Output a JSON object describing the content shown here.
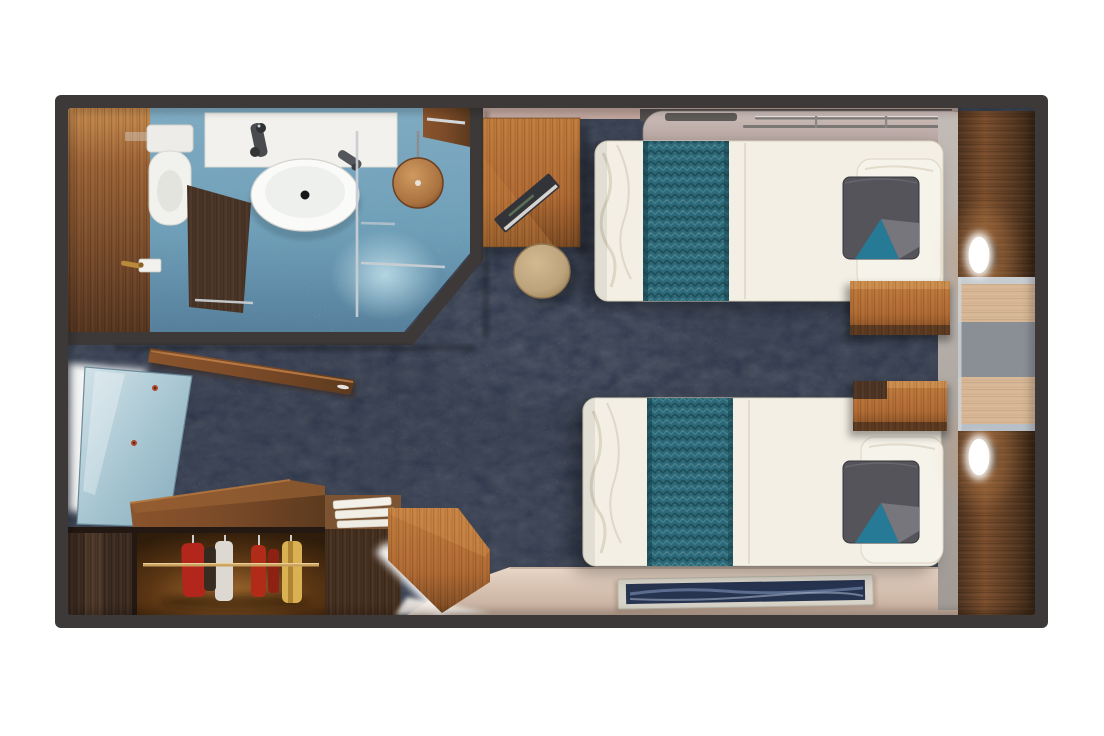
{
  "page": {
    "background_color": "#ffffff"
  },
  "floorplan": {
    "title": "Cruise stateroom floor plan — top-down 3D render",
    "rooms": {
      "bathroom": {
        "items": [
          "wood entry floor",
          "toilet",
          "vanity counter with oval washbasin",
          "chrome faucets",
          "glass shower partition",
          "bronze rain shower head",
          "towel rail",
          "blue tile floor",
          "angled corner wall"
        ]
      },
      "entry": {
        "items": [
          "mirrored door panel",
          "open wooden door",
          "corner wood counter",
          "wardrobe with hanging clothes (red, white, gold garments)",
          "towel shelf cabinet",
          "bench with illuminated edge"
        ]
      },
      "bedroom": {
        "items": [
          "upper twin bed",
          "lower twin bed",
          "teal herringbone bed runners",
          "grey and teal accent pillows",
          "white pillows",
          "fold-down berth with safety rail",
          "writing desk with open book",
          "round beige stool",
          "two wooden nightstands",
          "dark wood headboard wall",
          "two oval reading lights",
          "vanity recess with stone band",
          "navy abstract wall art",
          "beige deck strip",
          "dark mottled carpet"
        ]
      }
    }
  },
  "colors": {
    "page_bg": "#ffffff",
    "wall": "#3c3938",
    "carpet": "#49505e",
    "bath_floor": "#6f9fb8",
    "linen": "#f3efe4",
    "teal": "#2c6877",
    "sofa_gray": "#b9a8a4",
    "stool_beige": "#bda37c",
    "floor_beige": "#dcc6b6",
    "art_navy": "#273450",
    "wood_light": "#b06a33",
    "wood_mid": "#7a4a28",
    "wood_dark": "#46301f",
    "pillow_gray": "#54545a",
    "pillow_teal": "#267a95",
    "vanity_wood": "#d8b795",
    "granite": "#8b9097",
    "chrome": "#c9ced3",
    "bronze": "#a9713f",
    "wall_pink": "#c4aaa1",
    "gray_wall": "#b3aca8"
  }
}
